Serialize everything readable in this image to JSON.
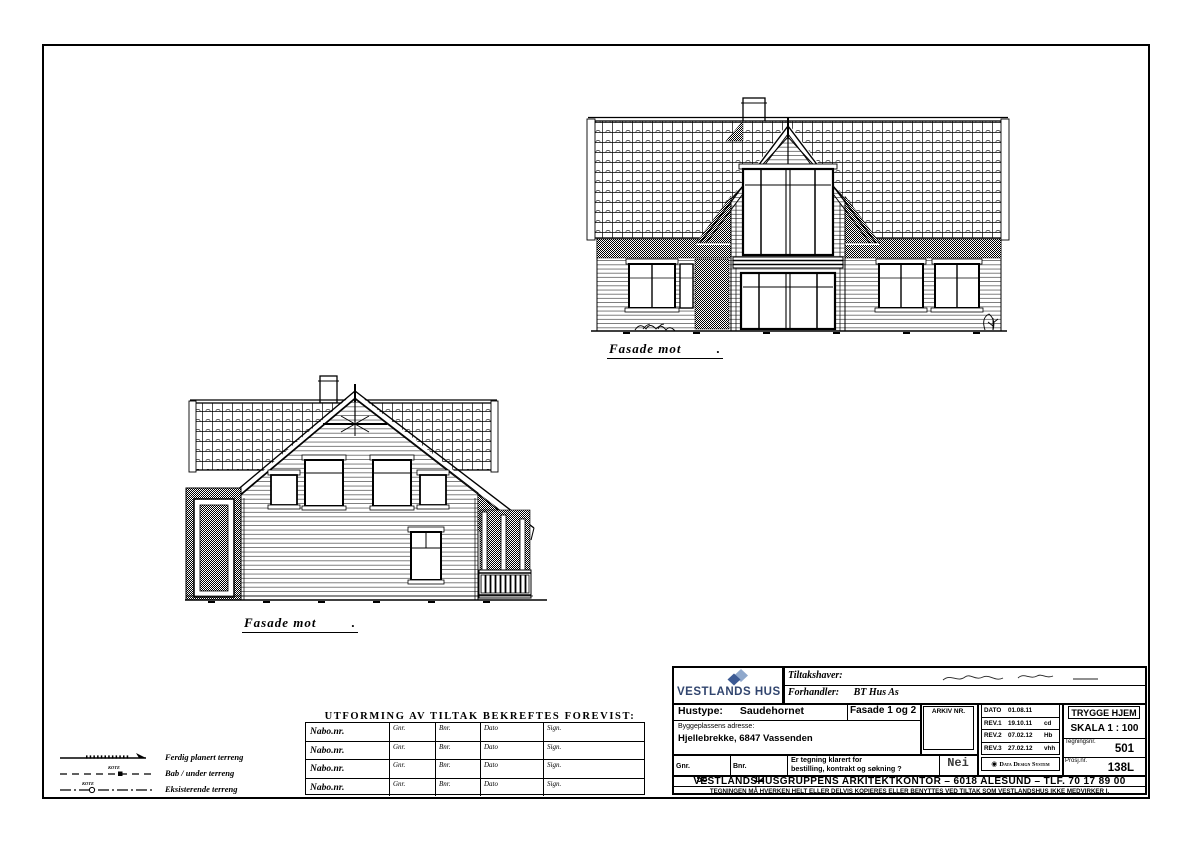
{
  "colors": {
    "ink": "#000000",
    "brand_navy": "#31456e",
    "brand_light_blue": "#8fa8cc",
    "brand_dark_blue": "#3c5a94",
    "nei_gray": "#3a3a3a"
  },
  "facade1": {
    "label": "Fasade mot",
    "suffix": "."
  },
  "facade2": {
    "label": "Fasade mot",
    "suffix": "."
  },
  "legend": {
    "items": [
      "Ferdig planert terreng",
      "Bab / under terreng",
      "Eksisterende terreng"
    ],
    "marker_text": "KOTE"
  },
  "neighbor_table": {
    "title": "UTFORMING AV TILTAK BEKREFTES FOREVIST:",
    "row_label": "Nabo.nr.",
    "col_headers": [
      "Gnr.",
      "Bnr.",
      "Dato",
      "Sign."
    ],
    "num_rows": 4
  },
  "title_block": {
    "brand": "VESTLANDS HUS",
    "tiltakshaver_label": "Tiltakshaver:",
    "forhandler_label": "Forhandler:",
    "forhandler_value": "BT Hus As",
    "hustype_label": "Hustype:",
    "hustype_value": "Saudehornet",
    "fasade_value": "Fasade 1 og 2",
    "address_label": "Byggeplassens adresse:",
    "address_value": "Hjellebrekke, 6847 Vassenden",
    "arkiv_label": "ARKIV  NR.",
    "gnr_label": "Gnr.",
    "gnr_value": "58",
    "bnr_label": "Bnr.",
    "bnr_value": "12",
    "klarert_line1": "Er tegning klarert for",
    "klarert_line2": "bestilling, kontrakt og søkning ?",
    "klarert_answer": "Nei",
    "dato_label": "DATO",
    "dato_value": "01.08.11",
    "revisions": [
      {
        "label": "REV.1",
        "date": "19.10.11",
        "sign": "cd"
      },
      {
        "label": "REV.2",
        "date": "07.02.12",
        "sign": "Hb"
      },
      {
        "label": "REV.3",
        "date": "27.02.12",
        "sign": "vhh"
      }
    ],
    "trygge_hjem": "TRYGGE HJEM",
    "skala": "SKALA 1 : 100",
    "tegningsnr_label": "Tegningsnr.",
    "tegningsnr_value": "501",
    "prosjnr_label": "Prosj.nr.",
    "prosjnr_value": "138L",
    "dds_name": "Data Design System",
    "office_line": "VESTLANDSHUSGRUPPENS ARKITEKTKONTOR – 6018 ALESUND – TLF. 70 17 89 00",
    "disclaimer": "TEGNINGEN MÅ HVERKEN HELT ELLER DELVIS KOPIERES ELLER BENYTTES VED TILTAK SOM VESTLANDSHUS IKKE MEDVIRKER I."
  }
}
